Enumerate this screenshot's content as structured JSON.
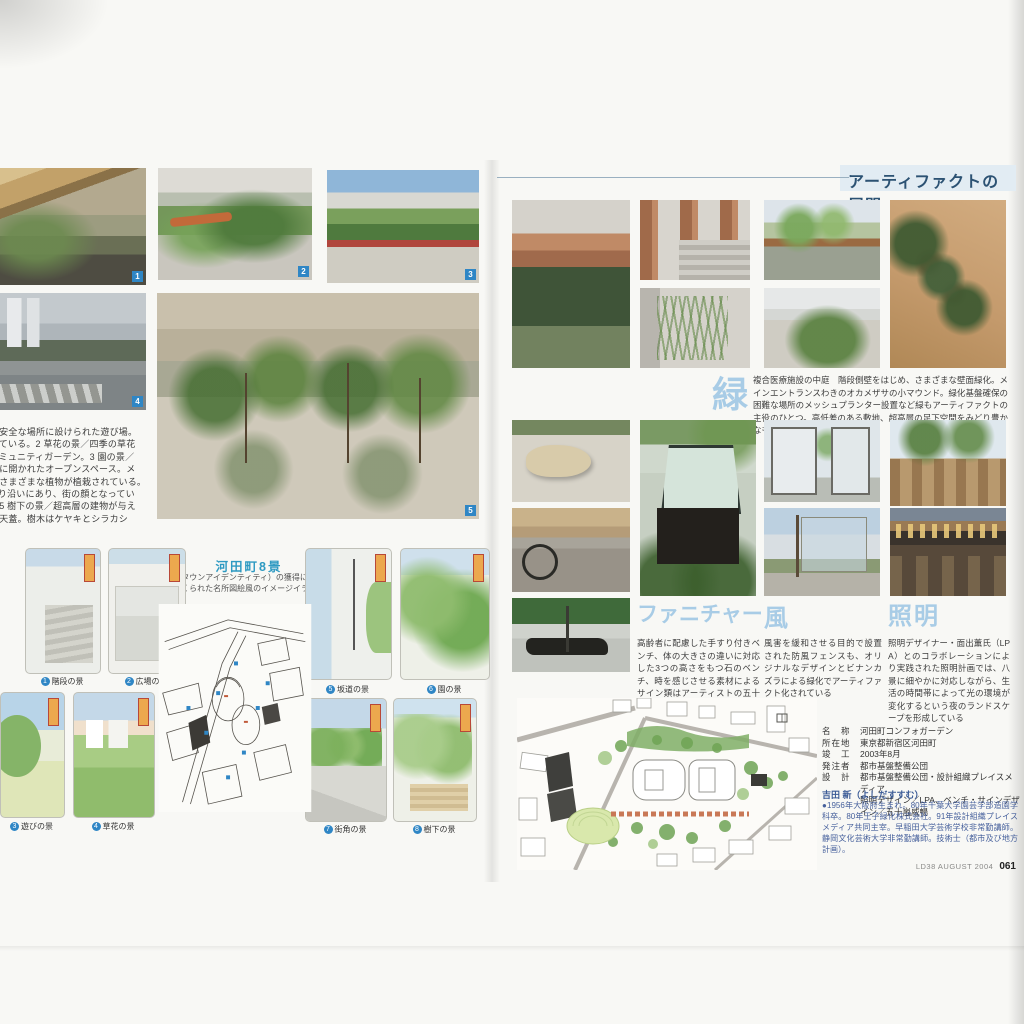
{
  "page": {
    "header_title": "アーティファクトの展開",
    "footer": {
      "issue": "LD38 AUGUST 2004",
      "page_no": "061"
    }
  },
  "left_page": {
    "photo_badges": [
      "1",
      "2",
      "3",
      "4",
      "5"
    ],
    "caption_lines": [
      "遊びの景／敷地内の最も安全な場所に設けられた遊び場。",
      "いつも子供たちで賑わっている。2 草花の景／四季の草花",
      "やハーブが植えられたコミュニティガーデン。3 園の景／",
      "駐車場上部は台地エリアに開かれたオープンスペース。メ",
      "ッシュプランターには、さまざまな植物が植栽されている。",
      "4 街角の景／女子医大通り沿いにあり、街の顔となってい",
      "るシマトネリコの広場。5 樹下の景／超高層の建物が与え",
      "る圧迫感を緩和する緑の天蓋。樹木はケヤキとシラカシ"
    ],
    "eight_views": {
      "title": "河田町8景",
      "subtitle_line1": "TI（タウンアイデンティティ）の獲得に向けて",
      "subtitle_line2": "つくられた名所図絵風のイメージイラスト",
      "captions": [
        {
          "num": "1",
          "label": "階段の景"
        },
        {
          "num": "2",
          "label": "広場の景"
        },
        {
          "num": "3",
          "label": "遊びの景"
        },
        {
          "num": "4",
          "label": "草花の景"
        },
        {
          "num": "5",
          "label": "坂道の景"
        },
        {
          "num": "6",
          "label": "園の景"
        },
        {
          "num": "7",
          "label": "街角の景"
        },
        {
          "num": "8",
          "label": "樹下の景"
        }
      ]
    }
  },
  "right_page": {
    "sections": [
      {
        "label": "緑",
        "text": "複合医療施設の中庭　階段側壁をはじめ、さまざまな壁面緑化。メインエントランスわきのオカメザサの小マウンド。緑化基盤確保の困難な場所のメッシュプランター設置など緑もアーティファクトの主役のひとつ。高低差のある敷地、超高層の足下空間をみどり豊かなものにしている"
      },
      {
        "label": "ファニチャー",
        "text": "高齢者に配慮した手すり付きベンチ、体の大きさの違いに対応した3つの高さをもつ石のベンチ、時を感じさせる素材によるサイン類はアーティストの五十嵐威暢氏とのコラボレーションによるもの"
      },
      {
        "label": "風",
        "text": "風害を緩和させる目的で設置された防風フェンスも、オリジナルなデザインとビナンカズラによる緑化でアーティファクト化されている"
      },
      {
        "label": "照明",
        "text": "照明デザイナー・面出薫氏（LPA）とのコラボレーションにより実践された照明計画では、八景に細やかに対応しながら、生活の時間帯によって光の環境が変化するという夜のランドスケープを形成している"
      }
    ],
    "project": {
      "rows": [
        {
          "key": "名　称",
          "value": "河田町コンフォガーデン"
        },
        {
          "key": "所在地",
          "value": "東京都新宿区河田町"
        },
        {
          "key": "竣　工",
          "value": "2003年8月"
        },
        {
          "key": "発注者",
          "value": "都市基盤整備公団"
        },
        {
          "key": "設　計",
          "value": "都市基盤整備公団・設計組織プレイスメディア"
        },
        {
          "key": "",
          "value": "照明デザイン／LPA、ベンチ・サインデザイン／五十嵐威暢"
        }
      ]
    },
    "bio": {
      "name": "吉田 新（よしだすすむ）",
      "text": "●1956年大阪府生まれ。80年千葉大学園芸学部造園学科卒。80年王子緑化株式会社。91年設計組織プレイスメディア共同主宰。早稲田大学芸術学校非常勤講師。静岡文化芸術大学非常勤講師。技術士（都市及び地方計画）。"
    }
  }
}
